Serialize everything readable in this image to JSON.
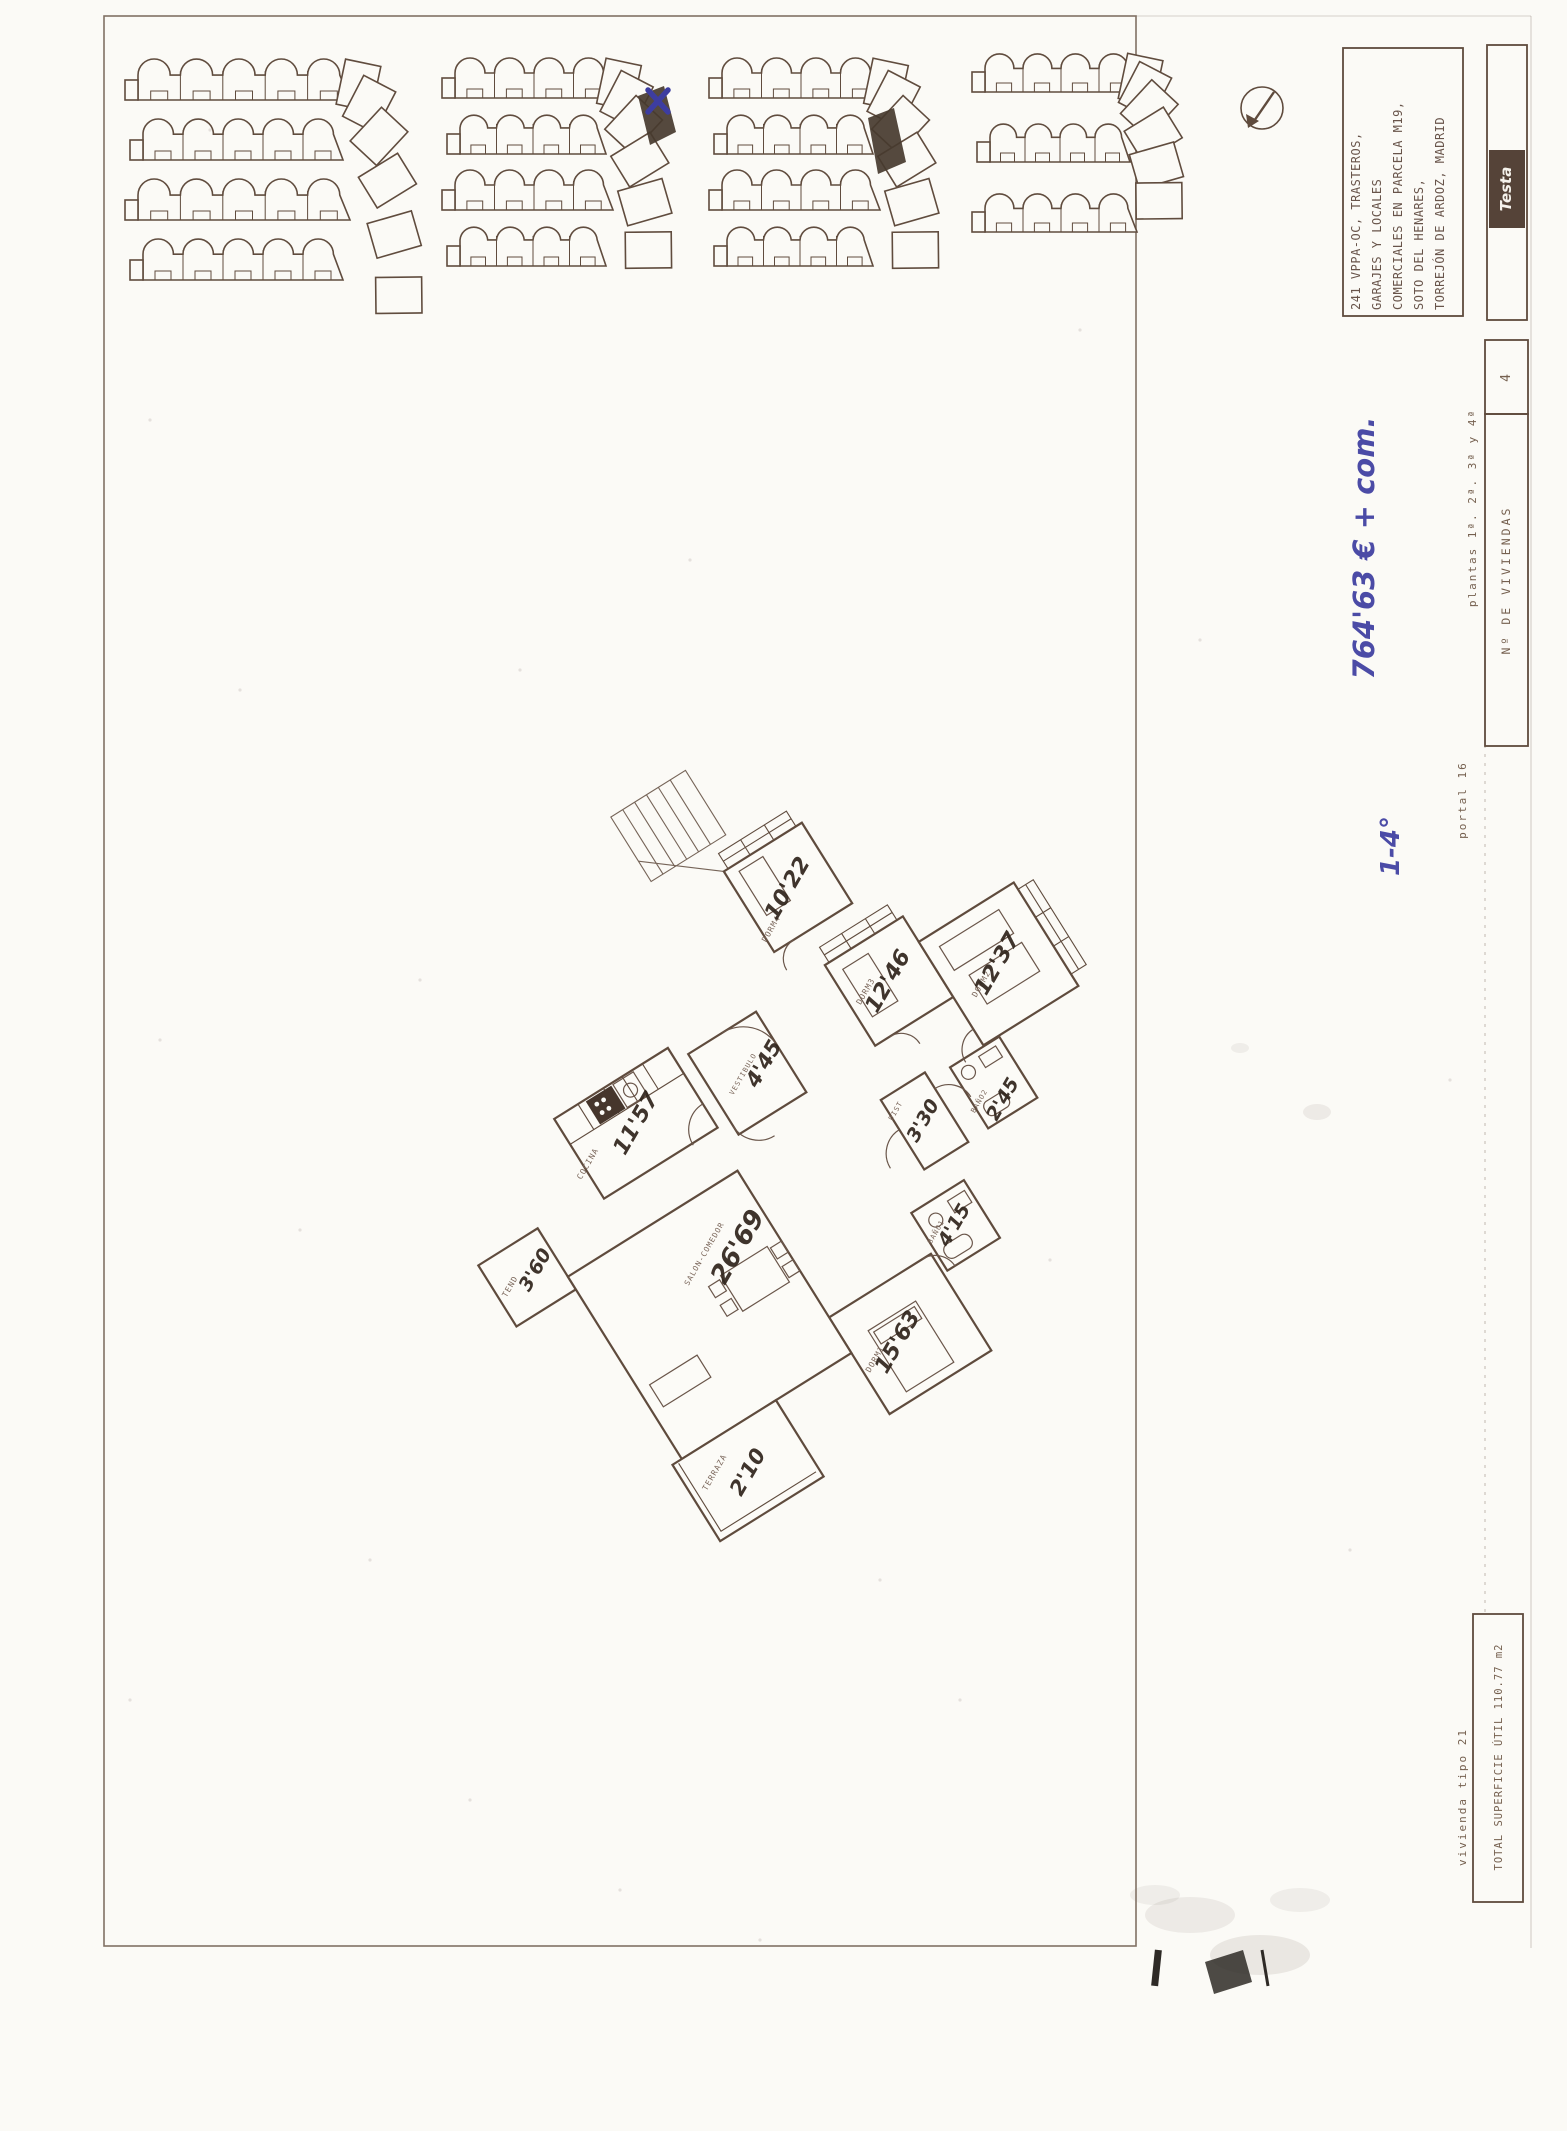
{
  "sheet": {
    "project_lines": [
      "241 VPPA-OC, TRASTEROS,",
      "GARAJES Y LOCALES",
      "COMERCIALES EN PARCELA M19,",
      "SOTO DEL HENARES,",
      "TORREJÓN DE ARDOZ, MADRID"
    ],
    "brand": "Testa",
    "plantas": "plantas 1ª. 2ª. 3ª y 4ª",
    "num_viviendas_label": "Nº DE VIVIENDAS",
    "num_viviendas_value": "4",
    "portal": "portal 16",
    "vivienda_tipo": "vivienda tipo 21",
    "superficie_total": "TOTAL SUPERFICIE ÚTIL 110.77 m2"
  },
  "handwritten": {
    "price": "764'63 € + com.",
    "floors": "1-4°",
    "ink_color": "#3d3da0"
  },
  "floor_plan": {
    "rooms": [
      {
        "name": "TEND",
        "area": "3'60"
      },
      {
        "name": "COCINA",
        "area": "11'57"
      },
      {
        "name": "VESTIBULO",
        "area": "4'45"
      },
      {
        "name": "DORM4",
        "area": "10'22"
      },
      {
        "name": "DORM3",
        "area": "12'46"
      },
      {
        "name": "DORM2",
        "area": "12'37"
      },
      {
        "name": "DIST",
        "area": "3'30"
      },
      {
        "name": "BAÑO2",
        "area": "2'45"
      },
      {
        "name": "BAÑO1",
        "area": "4'15"
      },
      {
        "name": "DORM1",
        "area": "15'63"
      },
      {
        "name": "SALON-COMEDOR",
        "area": "26'69"
      },
      {
        "name": "TERRAZA",
        "area": "2'10"
      }
    ]
  }
}
